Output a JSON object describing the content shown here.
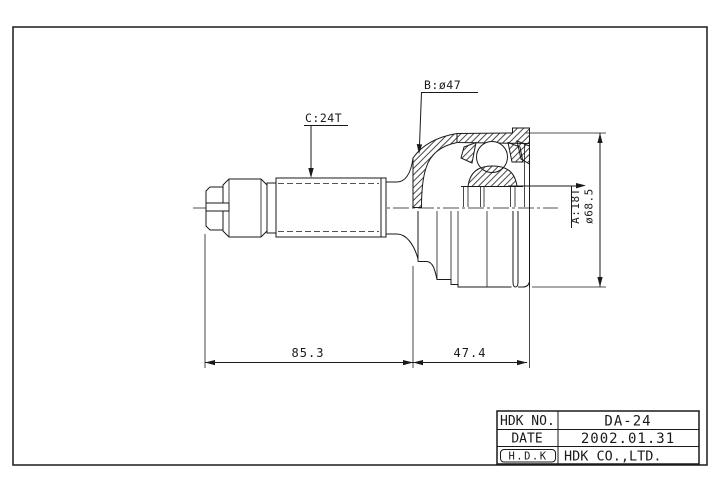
{
  "colors": {
    "line": "#1a1a1a",
    "background": "#ffffff"
  },
  "labels": {
    "spline": "C:24T",
    "boot_diameter": "B:ø47",
    "serration": "A:18T",
    "outer_diameter": "ø68.5"
  },
  "dimensions": {
    "shaft_length": "85.3",
    "joint_width": "47.4"
  },
  "title_block": {
    "part_no_label": "HDK NO.",
    "part_no": "DA-24",
    "date_label": "DATE",
    "date": "2002.01.31",
    "logo": "H.D.K",
    "company": "HDK CO.,LTD."
  }
}
